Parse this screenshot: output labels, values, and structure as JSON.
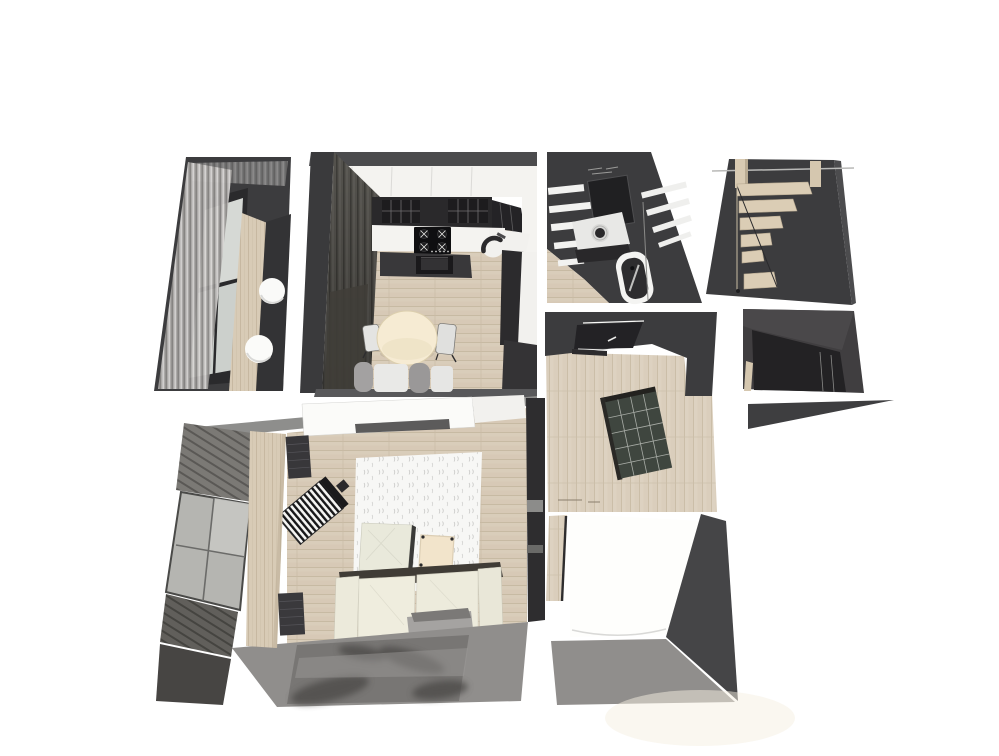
{
  "palette": {
    "bg": "#ffffff",
    "wallDark": "#3c3c3e",
    "wallSide": "#4b4b4d",
    "wallDeep": "#29282a",
    "doorDark": "#232225",
    "counterDark": "#2a292b",
    "cabinetWhite": "#f4f3f0",
    "white": "#fbfbf9",
    "cream": "#f6ebd3",
    "creamDeep": "#f2e4cb",
    "sageCream": "#e9e9db",
    "woodFloor": "#d9cdba",
    "woodLight": "#dbcdb5",
    "grayFloor": "#908e8c",
    "grayBand": "#8e8e8c",
    "rugDark": "#787674",
    "glass": "#b5b5b1",
    "glassLight": "#c7c7c3",
    "shelfGreen": "#3f463f",
    "sofaBack": "#403c36",
    "sofaCream": "#efedde",
    "trayGray": "#a5a3a1",
    "radiatorWhite": "#f4f4f2",
    "windowPane": "#d6d9d5",
    "bathDark": "#3c3c3e",
    "tubInner": "#2e2d2f",
    "glow": "#f6f0e2"
  },
  "scene": {
    "type": "3d-floorplan-render",
    "view": "bird's-eye dollhouse",
    "rooms": [
      {
        "name": "upper-balcony",
        "furniture": [
          "curtains",
          "window-panes",
          "wood-strip",
          "pouf",
          "pouf"
        ]
      },
      {
        "name": "kitchen",
        "furniture": [
          "upper-cabinets",
          "glass-cabinet",
          "countertop",
          "cooktop",
          "oven",
          "sink",
          "dining-table",
          "chair",
          "chair"
        ]
      },
      {
        "name": "bathroom",
        "furniture": [
          "white-steps",
          "mirror",
          "vanity-sink",
          "bathtub"
        ]
      },
      {
        "name": "staircase",
        "furniture": [
          "wood-posts",
          "wood-steps",
          "handrail"
        ]
      },
      {
        "name": "hallway",
        "furniture": [
          "door",
          "shelving-unit"
        ]
      },
      {
        "name": "wardrobe-nook",
        "furniture": [
          "dark-wardrobe"
        ]
      },
      {
        "name": "living-room",
        "furniture": [
          "white-wardrobe",
          "tv-unit",
          "quilted-rug",
          "ottoman",
          "play-mat",
          "radiator",
          "sofa",
          "footrest-tray",
          "dark-rug",
          "balcony-glazing",
          "wood-divider",
          "shutter-panels"
        ]
      },
      {
        "name": "bedroom",
        "furniture": [
          "white-bed"
        ]
      }
    ]
  }
}
